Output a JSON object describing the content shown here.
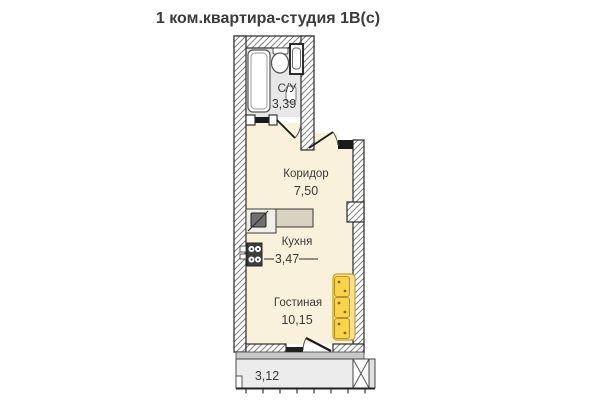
{
  "title": "1 ком.квартира-студия 1В(с)",
  "plan": {
    "bathroom": {
      "label": "С/У",
      "area": "3,39"
    },
    "corridor": {
      "label": "Коридор",
      "area": "7,50"
    },
    "kitchen": {
      "label": "Кухня",
      "area": "3,47"
    },
    "living_room": {
      "label": "Гостиная",
      "area": "10,15"
    },
    "balcony": {
      "area": "3,12"
    },
    "colors": {
      "floor": "#faf1dd",
      "wet_floor": "#e8e8e8",
      "balcony_floor": "#ececec",
      "sill": "#c8c8c8",
      "counter": "#d9d2c0",
      "sofa": "#f6d44c",
      "sofa_back": "#fce38a",
      "stove": "#3f3f3f"
    }
  }
}
